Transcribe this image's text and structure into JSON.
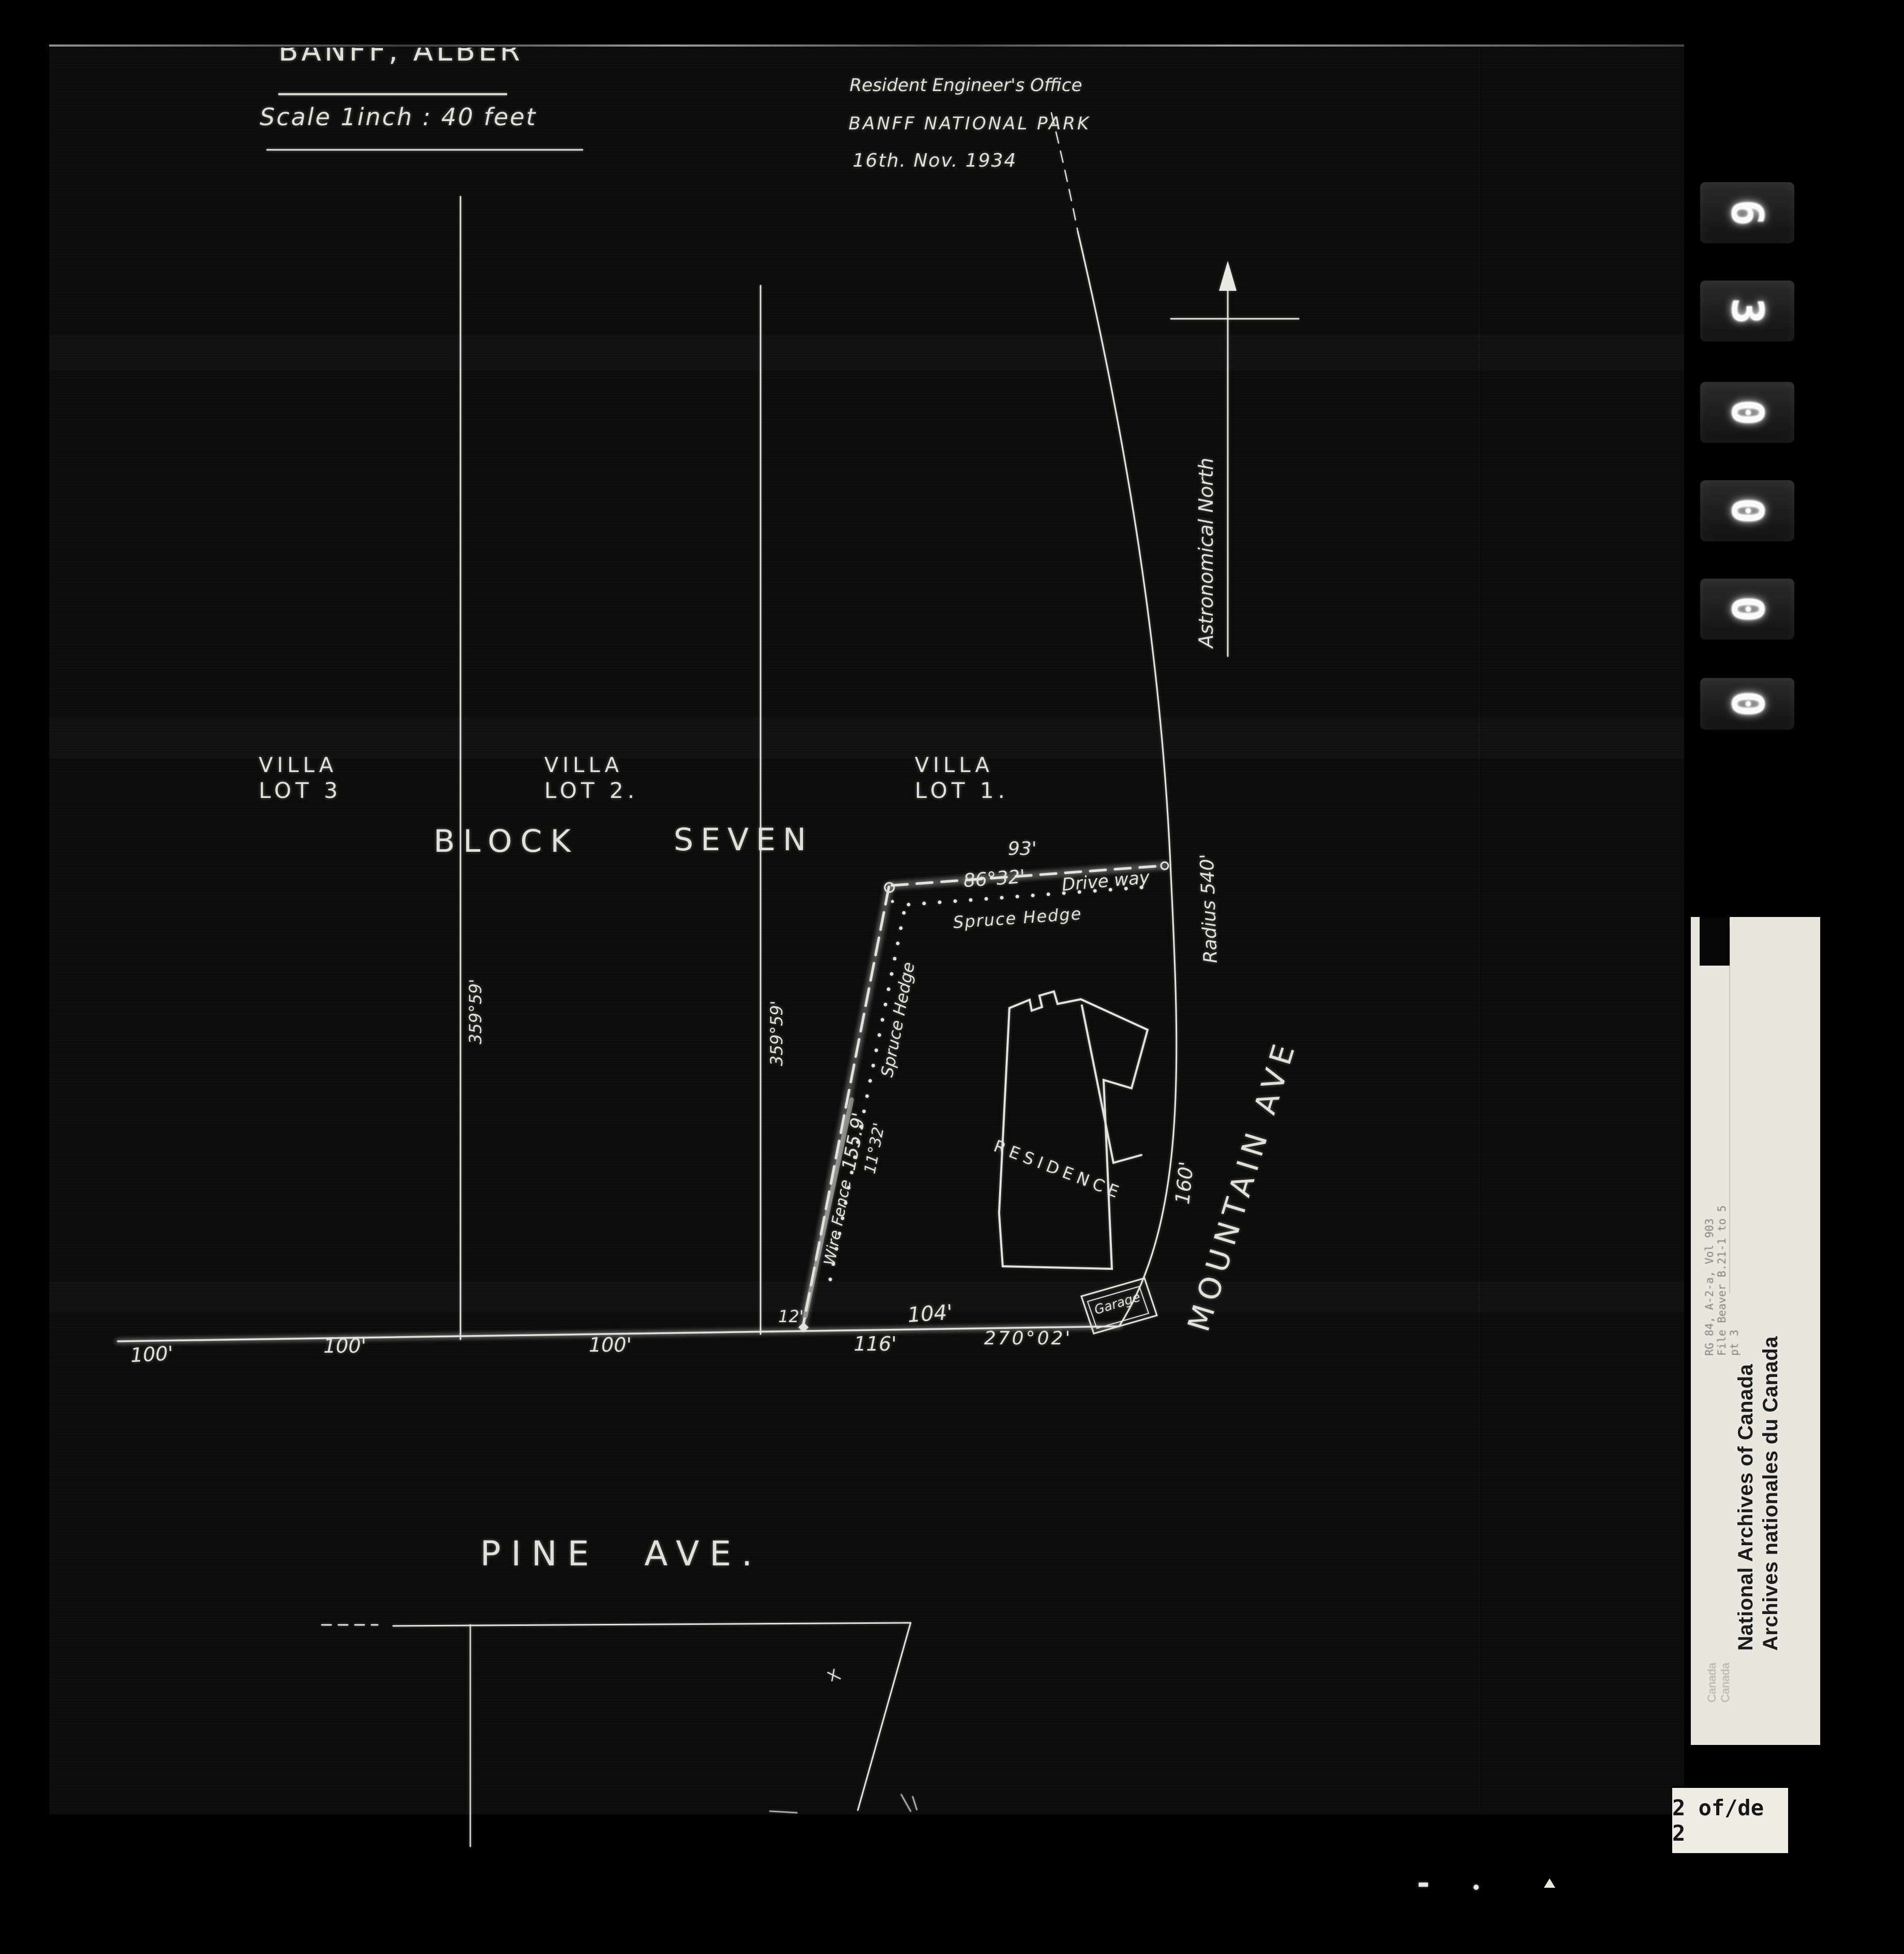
{
  "film": {
    "counter_digits": [
      "6",
      "3",
      "0",
      "0",
      "0",
      "0"
    ],
    "page_label": "2 of/de 2"
  },
  "title_block": {
    "title": "BANFF, ALBERTA.",
    "scale_note": "Scale 1inch : 40 feet"
  },
  "engineer_block": {
    "office": "Resident Engineer's Office",
    "park": "BANFF NATIONAL PARK",
    "date": "16th. Nov. 1934"
  },
  "north_arrow": {
    "label": "Astronomical North"
  },
  "block": {
    "word1": "BLOCK",
    "word2": "SEVEN"
  },
  "lots": [
    {
      "line1": "VILLA",
      "line2": "LOT 3"
    },
    {
      "line1": "VILLA",
      "line2": "LOT 2."
    },
    {
      "line1": "VILLA",
      "line2": "LOT 1."
    }
  ],
  "bearings": {
    "west_line": "359°59'",
    "east_line": "359°59'",
    "top": "86°32'",
    "left": "11°32'",
    "bottom": "270°02'"
  },
  "parcel": {
    "top_length": "93'",
    "driveway": "Drive way",
    "radius_label": "Radius 540'",
    "hedge_top": "Spruce Hedge",
    "hedge_left": "Spruce Hedge",
    "left_length": "155.9'",
    "fence_label": "Wire Fence",
    "frontage_length": "160'",
    "building_label": "RESIDENCE",
    "garage_label": "Garage",
    "offset_left": "12'",
    "bottom_length": "116'",
    "bottom_right_length": "104'"
  },
  "streets": {
    "pine": "PINE AVE.",
    "mountain": "MOUNTAIN AVE"
  },
  "baseline": {
    "m1": "100'",
    "m2": "100'",
    "m3": "100'"
  },
  "archives_label": {
    "english": "National Archives of Canada",
    "french": "Archives nationales du Canada",
    "reference_lines": [
      "RG 84, A-2-a, Vol 903",
      "File Beaver B.21-1 to 5",
      "pt 3"
    ],
    "bottom_faint": [
      "Canada",
      "Canada"
    ]
  },
  "colors": {
    "background": "#000000",
    "film": "#0c0c0b",
    "ink": "#e3e2dc",
    "label_paper": "#e9e6df",
    "label_text": "#1c1c1c"
  }
}
